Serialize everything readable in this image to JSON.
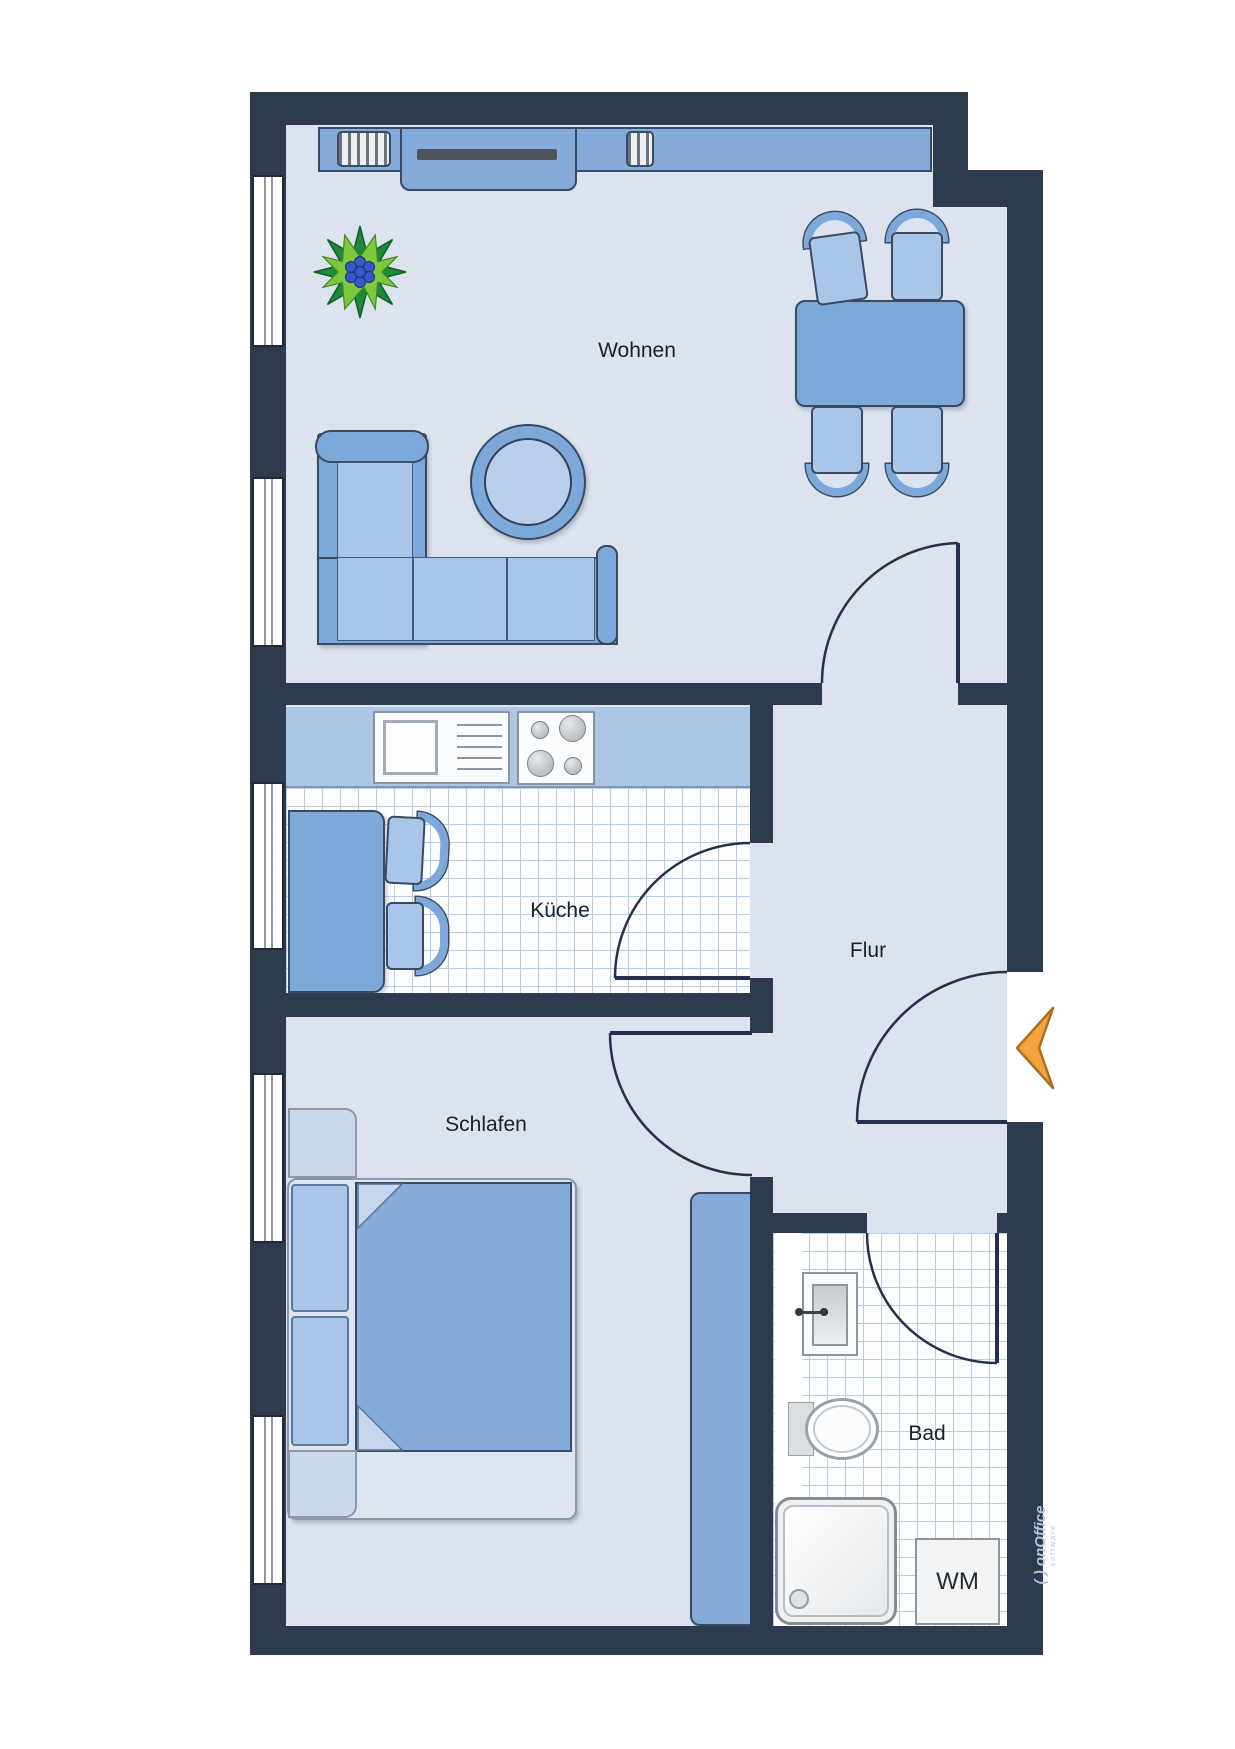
{
  "floorplan": {
    "rooms": {
      "living": {
        "label": "Wohnen"
      },
      "kitchen": {
        "label": "Küche"
      },
      "hall": {
        "label": "Flur"
      },
      "bedroom": {
        "label": "Schlafen"
      },
      "bathroom": {
        "label": "Bad"
      }
    },
    "appliances": {
      "washing_machine_label": "WM"
    },
    "watermark": {
      "brand": "( ) onOffice",
      "sub": "software"
    },
    "icons": [
      "plant-icon",
      "entrance-arrow-icon"
    ],
    "palette": {
      "wall": "#2e3b4f",
      "room_floor": "#dce3ee",
      "tile_line": "#b7cee0",
      "furniture_mid_blue": "#7da8da",
      "furniture_blue": "#85abdb",
      "furniture_light_blue": "#a9c6e8",
      "furniture_pale": "#dde5f0",
      "kitchen_counter": "#abc7e5",
      "tv_gray": "#4d545c",
      "entrance_arrow": "#f4a43c",
      "plant_dark_green": "#1e8a3c",
      "plant_light_green": "#7dc83e",
      "plant_berries": "#3558c8",
      "fixture_border": "#8e959c",
      "label_color": "#17202b",
      "watermark_color": "#b6c5de"
    }
  }
}
